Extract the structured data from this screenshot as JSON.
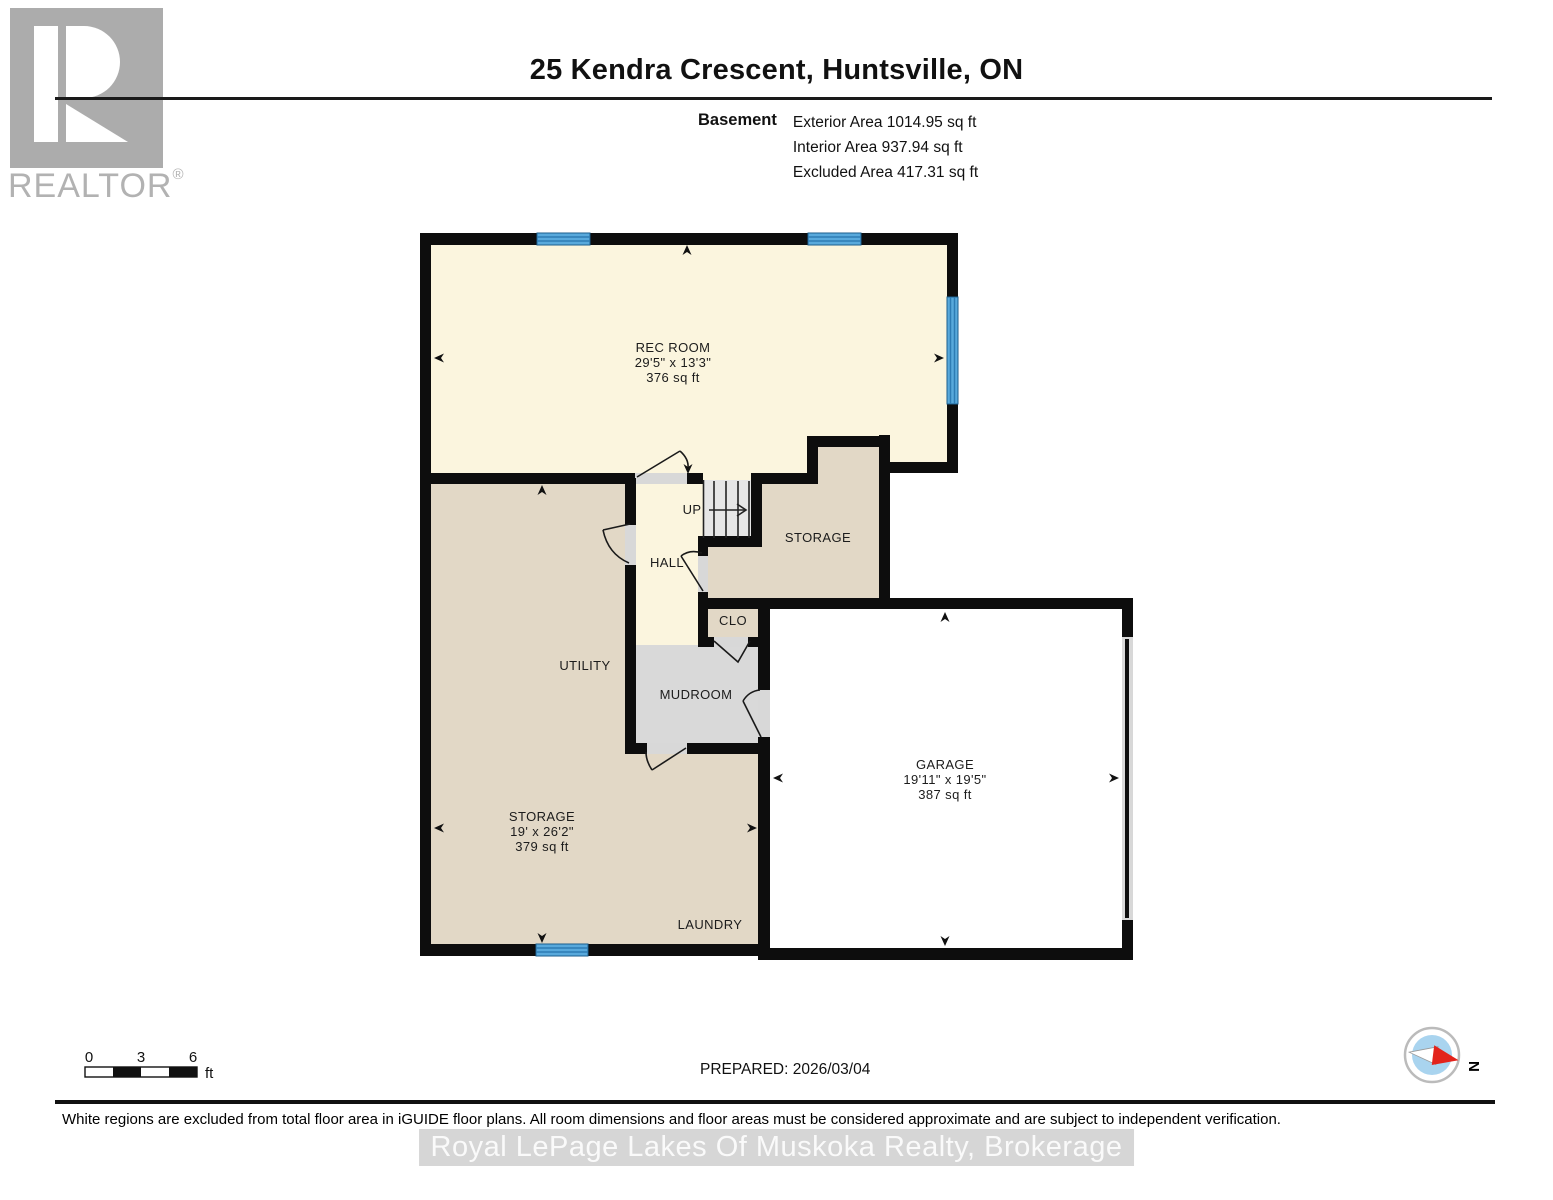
{
  "logo": {
    "brand": "REALTOR",
    "reg": "®"
  },
  "header": {
    "title": "25 Kendra Crescent, Huntsville, ON",
    "floor_label": "Basement",
    "exterior_area": "Exterior Area 1014.95 sq ft",
    "interior_area": "Interior Area 937.94 sq ft",
    "excluded_area": "Excluded Area 417.31 sq ft"
  },
  "rooms": {
    "rec_room": {
      "name": "REC ROOM",
      "dims": "29'5\" x 13'3\"",
      "area": "376 sq ft"
    },
    "utility": {
      "name": "UTILITY"
    },
    "storage_main": {
      "name": "STORAGE",
      "dims": "19' x 26'2\"",
      "area": "379 sq ft"
    },
    "laundry": {
      "name": "LAUNDRY"
    },
    "hall": {
      "name": "HALL"
    },
    "up": {
      "name": "UP"
    },
    "storage_small": {
      "name": "STORAGE"
    },
    "clo": {
      "name": "CLO"
    },
    "mudroom": {
      "name": "MUDROOM"
    },
    "garage": {
      "name": "GARAGE",
      "dims": "19'11\" x 19'5\"",
      "area": "387 sq ft"
    }
  },
  "scale_bar": {
    "tick0": "0",
    "tick3": "3",
    "tick6": "6",
    "unit": "ft"
  },
  "prepared": "PREPARED: 2026/03/04",
  "compass": {
    "north_label": "N"
  },
  "footer": {
    "disclaimer": "White regions are excluded from total floor area in iGUIDE floor plans. All room dimensions and floor areas must be considered approximate and are subject to independent verification.",
    "watermark": "Royal LePage Lakes Of Muskoka Realty, Brokerage"
  },
  "colors": {
    "room_cream": "#FBF5DE",
    "room_tan": "#E2D8C6",
    "room_gray": "#D9D9D9",
    "wall_black": "#0d0d0d",
    "window_blue": "#58A9DC",
    "window_stripe": "#2D7CB4",
    "compass_blue": "#A9D4EF",
    "compass_red": "#E3231B"
  }
}
